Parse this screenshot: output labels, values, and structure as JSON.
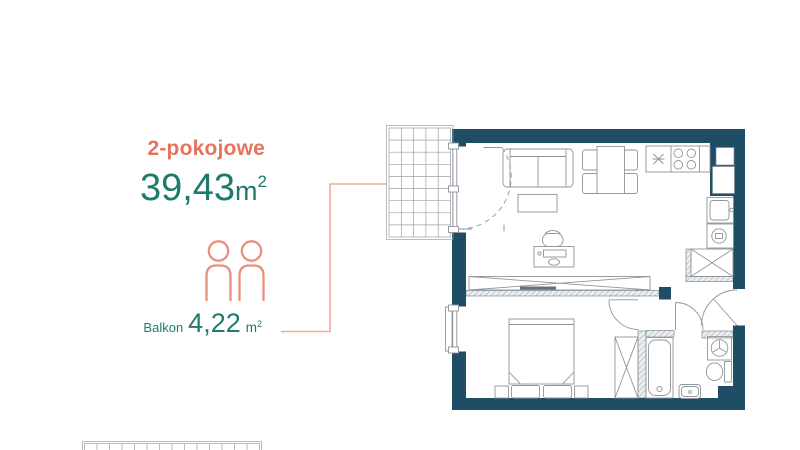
{
  "panel": {
    "unit_type": "2-pokojowe",
    "area": {
      "value": "39,43",
      "unit": "m",
      "sup": "2"
    },
    "occupancy_persons": 2,
    "balcony": {
      "label": "Balkon",
      "value": "4,22",
      "unit": "m",
      "sup": "2"
    }
  },
  "colors": {
    "accent_coral": "#e5735e",
    "accent_teal": "#1c7b6d",
    "connector_coral": "#f2a896",
    "person_coral": "#ea8f7c",
    "wall_navy": "#1f4d66"
  },
  "floor_plan": {
    "fixtures": [
      "balcony-grid",
      "balcony-door",
      "sofa",
      "coffee-table",
      "dining-table-4-chairs",
      "desk-with-chair",
      "fridge",
      "stove",
      "kitchen-sink",
      "dishwasher",
      "entrance-wardrobe",
      "sliding-wardrobe",
      "double-bed",
      "nightstands",
      "bedroom-window",
      "bedroom-wardrobe",
      "bathtub",
      "washing-machine",
      "toilet",
      "washbasin",
      "entrance-door",
      "bedroom-door",
      "bathroom-door",
      "ventilation-shafts",
      "adjacent-plan-fragment"
    ]
  }
}
